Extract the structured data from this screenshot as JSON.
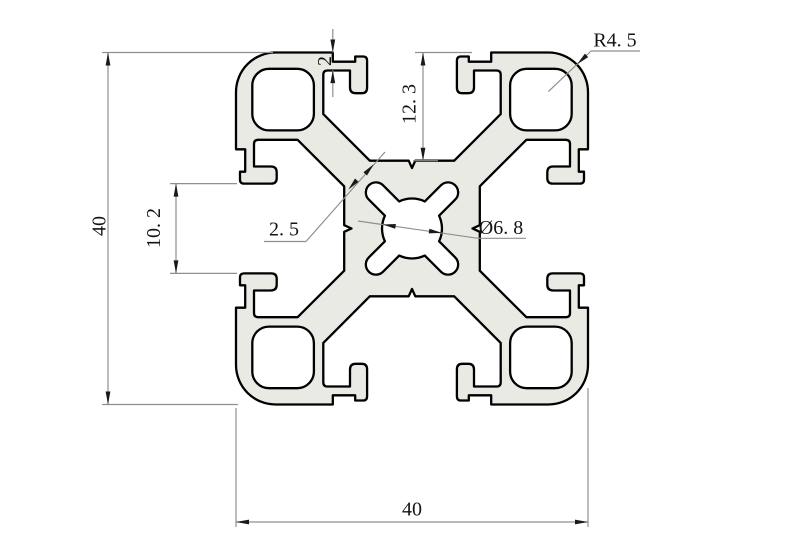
{
  "drawing": {
    "title": "40x40 aluminum extrusion profile cross-section",
    "dimensions": {
      "overall_height": "40",
      "overall_width": "40",
      "slot_lip_thickness": "2",
      "slot_depth": "12. 3",
      "slot_opening": "10. 2",
      "web_thickness": "2. 5",
      "center_hole_diameter": "Ø6. 8",
      "corner_radius": "R4. 5"
    },
    "colors": {
      "profile_fill": "#eaeae4",
      "outline": "#000000",
      "dimension_line": "#8f8f8f",
      "arrow": "#1a1a1a",
      "text": "#141414",
      "background": "#ffffff"
    }
  }
}
